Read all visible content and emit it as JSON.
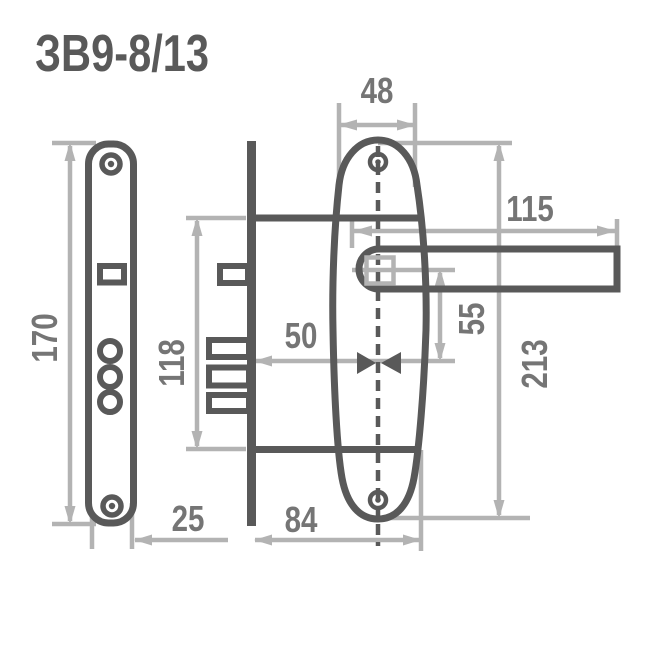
{
  "title": "ЗВ9-8/13",
  "colors": {
    "part_outline": "#595959",
    "dimension_line": "#b3b3b3",
    "dimension_text": "#757575",
    "background": "#ffffff"
  },
  "drawing": {
    "description": "mortise-lock-technical-drawing",
    "dimensions": {
      "faceplate_height": "170",
      "faceplate_width": "25",
      "lock_case_height": "118",
      "lock_case_depth": "84",
      "backset": "50",
      "escutcheon_width": "48",
      "handle_length": "115",
      "handle_to_keyhole": "55",
      "escutcheon_height": "213"
    }
  }
}
